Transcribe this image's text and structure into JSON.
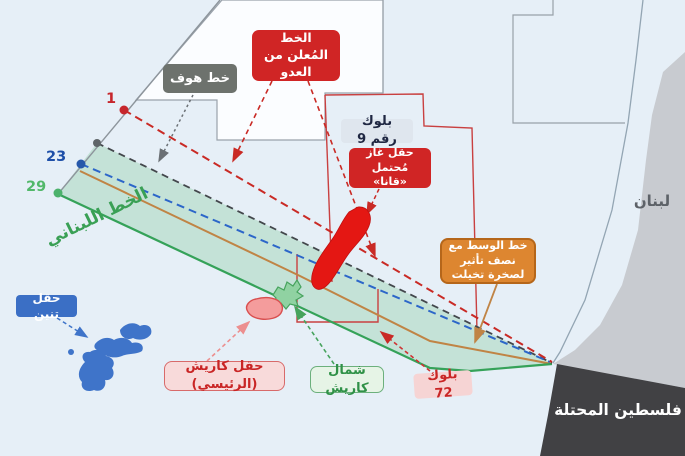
{
  "labels": {
    "enemy_line": "الخط المُعلن من العدو",
    "hof_line": "خط هوف",
    "block9": "بلوك رقم 9",
    "qana_field": "حقل غاز مُحتمل «قانا»",
    "midline": "خط الوسط مع نصف تأثير لصخرة تخيلت",
    "lebanese_line": "الخط اللبناني",
    "tanin_field": "حقل تنين",
    "karish_field": "حقل كاريش (الرئيسي)",
    "north_karish": "شمال كاريش",
    "block72": "بلوك 72",
    "lebanon": "لبنان",
    "palestine": "فلسطين المحتلة"
  },
  "points": {
    "line1": "1",
    "line23": "23",
    "line29": "29"
  },
  "colors": {
    "sea": "#e6eff7",
    "enemy_red": "#d02525",
    "hof_grey": "#6d726d",
    "lebanese_green": "#3aa055",
    "midline_orange": "#dd8630",
    "zone_green": "#a8d7bd",
    "land_lebanon": "#c8cbd0",
    "land_palestine": "#414144",
    "line1_red": "#c92a25",
    "line23_blue": "#2c66c9",
    "qana_field_red": "#e41713",
    "tanin_blue": "#3f74c9",
    "block_border_red": "#c94040"
  }
}
